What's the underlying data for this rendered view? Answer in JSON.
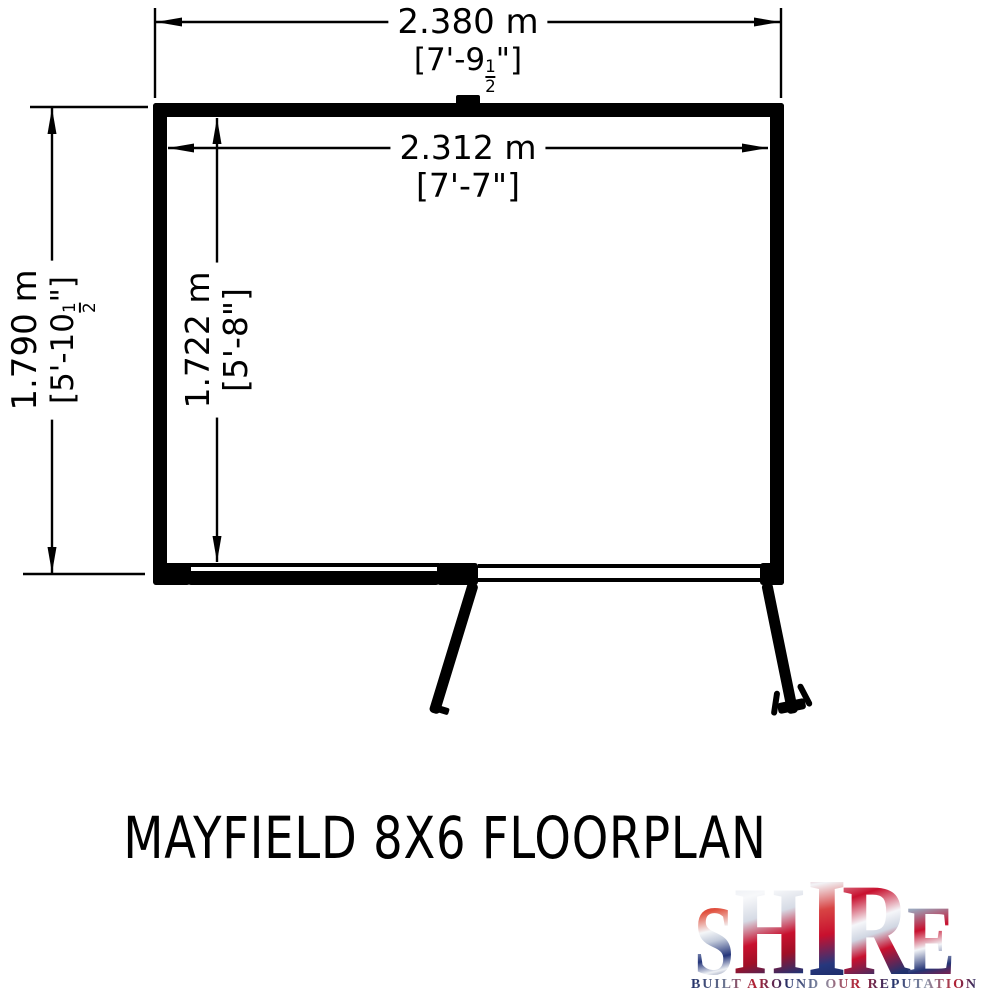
{
  "page": {
    "background_color": "#ffffff",
    "drawing_color": "#000000"
  },
  "floorplan": {
    "dimensions": {
      "outer_width": {
        "metric": "2.380 m",
        "imperial_prefix": "[7'-9",
        "frac_num": "1",
        "frac_den": "2",
        "imperial_suffix": "\"]"
      },
      "inner_width": {
        "metric": "2.312 m",
        "imperial_prefix": "[7'-7\"]",
        "frac_num": "",
        "frac_den": "",
        "imperial_suffix": ""
      },
      "outer_depth": {
        "metric": "1.790 m",
        "imperial_prefix": "[5'-10",
        "frac_num": "1",
        "frac_den": "2",
        "imperial_suffix": "\"]"
      },
      "inner_depth": {
        "metric": "1.722 m",
        "imperial_prefix": "[5'-8\"]",
        "frac_num": "",
        "frac_den": "",
        "imperial_suffix": ""
      }
    }
  },
  "title": "MAYFIELD 8X6 FLOORPLAN",
  "logo": {
    "brand_letters": [
      "S",
      "H",
      "I",
      "R",
      "E"
    ],
    "tagline": "BUILT AROUND OUR REPUTATION",
    "colors": {
      "navy": "#1e2d66",
      "red": "#c8102e",
      "silver": "#d9dee8"
    }
  }
}
